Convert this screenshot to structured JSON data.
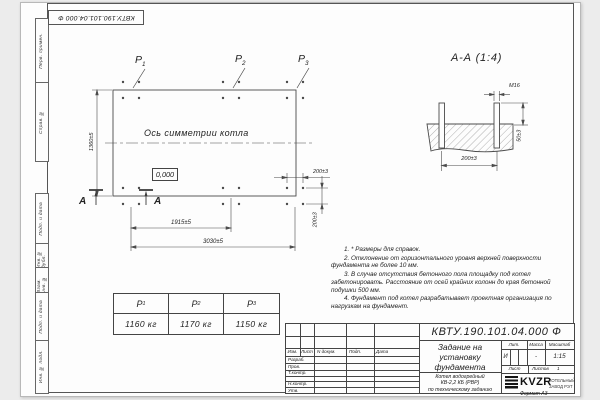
{
  "doc_number": "КВТУ.190.101.04.000 Ф",
  "frame": {
    "side_labels": [
      "Перв. примен.",
      "Справ. №",
      "Подп. и дата",
      "Инв. № дубл.",
      "Взам. инв. №",
      "Подп. и дата",
      "Инв. № подл."
    ],
    "format_note": "Формат А3"
  },
  "plan": {
    "axis_label": "Ось симметрии котла",
    "level_mark": "0,000",
    "point_labels": [
      {
        "name": "Р",
        "sub": "1"
      },
      {
        "name": "Р",
        "sub": "2"
      },
      {
        "name": "Р",
        "sub": "3"
      }
    ],
    "section_letter": "А",
    "dim_height": "1360±5",
    "dim_mid": "1915±5",
    "dim_total": "3030±5",
    "dim_bolt_x": "200±3",
    "dim_bolt_y": "200±3"
  },
  "section_view": {
    "title": "А-А (1:4)",
    "bolt_thread": "М16",
    "dim_protrusion": "50±3",
    "dim_spacing": "200±3"
  },
  "notes": [
    "1. * Размеры для справок.",
    "2. Отклонение от горизонтального уровня верхней поверхности фундамента не более 10 мм.",
    "3. В случае отсутствия бетонного пола площадку под котел забетонировать. Расстояние от осей крайних колонн до края бетонной подушки 500 мм.",
    "4. Фундамент под котел разрабатывает проектная организация по нагрузкам на фундамент."
  ],
  "load_table": {
    "headers": [
      {
        "name": "Р",
        "sub": "1"
      },
      {
        "name": "Р",
        "sub": "2"
      },
      {
        "name": "Р",
        "sub": "3"
      }
    ],
    "values": [
      "1160 кг",
      "1170 кг",
      "1150 кг"
    ]
  },
  "title_block": {
    "doc_number": "КВТУ.190.101.04.000 Ф",
    "title": [
      "Задание на",
      "установку",
      "фундамента"
    ],
    "subtitle": [
      "Котел водогрейный",
      "КВ-2,2 КБ (РВР)",
      "по техническому заданию"
    ],
    "columns": [
      "Изм.",
      "Лист",
      "N докум.",
      "Подп.",
      "Дата"
    ],
    "rows": [
      "Разраб.",
      "Пров.",
      "Т.контр.",
      "Н.контр.",
      "Утв."
    ],
    "lit_header": "Лит.",
    "mass_header": "Масса",
    "scale_header": "Масштаб",
    "lit_value": "И",
    "mass_value": "-",
    "scale_value": "1:15",
    "sheet_label": "Лист",
    "sheets_label": "Листов",
    "sheets_value": "1",
    "logo_text": "KVZR",
    "logo_caption": [
      "КОТЕЛЬНЫЙ",
      "ЗАВОД РЭТ"
    ]
  },
  "colors": {
    "line": "#4a4a4a",
    "text": "#222222"
  }
}
